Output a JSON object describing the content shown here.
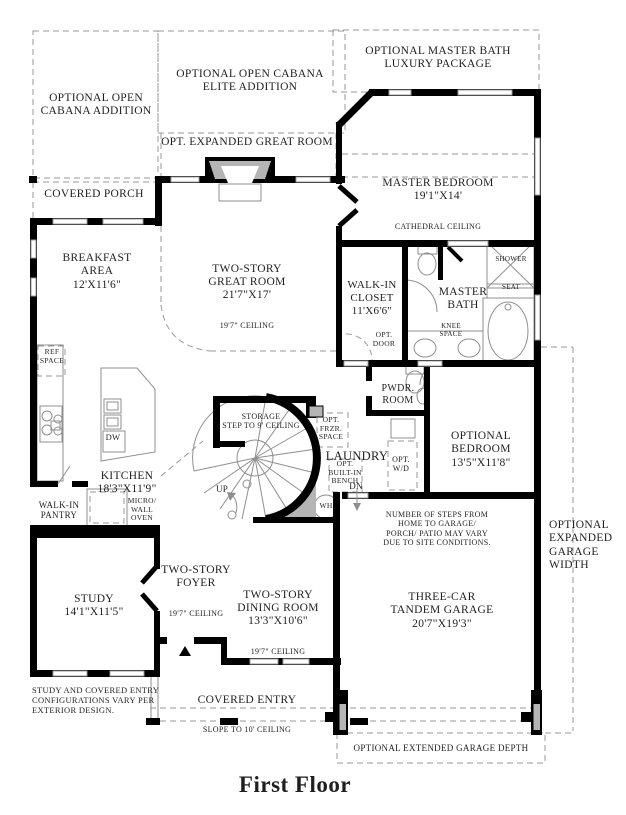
{
  "title": "First Floor",
  "palette": {
    "wall": "#000000",
    "dashed_line": "#9a9a9a",
    "fixture_line": "#8f8f8f",
    "poche_gray": "#b5b5b5",
    "text": "#1f1f1f"
  },
  "labels": {
    "cabana": {
      "text": "OPTIONAL OPEN\nCABANA ADDITION"
    },
    "cabanaElite": {
      "text": "OPTIONAL OPEN CABANA\nELITE ADDITION"
    },
    "masterBathLux": {
      "text": "OPTIONAL MASTER BATH\nLUXURY PACKAGE"
    },
    "optExpandedGreatRoom": {
      "text": "OPT. EXPANDED GREAT ROOM"
    },
    "coveredPorch": {
      "text": "COVERED PORCH"
    },
    "masterBedroom": {
      "text": "MASTER BEDROOM\n19'1\"X14'",
      "note": "CATHEDRAL CEILING"
    },
    "breakfast": {
      "text": "BREAKFAST\nAREA\n12'X11'6\""
    },
    "greatRoom": {
      "text": "TWO-STORY\nGREAT ROOM\n21'7\"X17'",
      "note": "19'7\" CEILING"
    },
    "walkInCloset": {
      "text": "WALK-IN\nCLOSET\n11'X6'6\""
    },
    "masterBath": {
      "text": "MASTER\nBATH"
    },
    "shower": {
      "text": "SHOWER"
    },
    "seat": {
      "text": "SEAT"
    },
    "kneeSpace": {
      "text": "KNEE\nSPACE"
    },
    "optDoor": {
      "text": "OPT.\nDOOR"
    },
    "refSpace": {
      "text": "REF\nSPACE"
    },
    "dw": {
      "text": "DW"
    },
    "kitchen": {
      "text": "KITCHEN\n18'3\"X11'9\""
    },
    "walkInPantry": {
      "text": "WALK-IN\nPANTRY"
    },
    "microWallOven": {
      "text": "MICRO/\nWALL\nOVEN"
    },
    "storage": {
      "text": "STORAGE\nSTEP TO 9' CEILING"
    },
    "optFrzr": {
      "text": "OPT.\nFRZR.\nSPACE"
    },
    "laundry": {
      "text": "LAUNDRY"
    },
    "optWd": {
      "text": "OPT.\nW/D"
    },
    "optBench": {
      "text": "OPT.\nBUILT-IN\nBENCH"
    },
    "up": {
      "text": "UP"
    },
    "dn": {
      "text": "DN"
    },
    "wh": {
      "text": "WH"
    },
    "pwdr": {
      "text": "PWDR.\nROOM"
    },
    "optBedroom": {
      "text": "OPTIONAL\nBEDROOM\n13'5\"X11'8\""
    },
    "study": {
      "text": "STUDY\n14'1\"X11'5\""
    },
    "foyer": {
      "text": "TWO-STORY\nFOYER",
      "note": "19'7\" CEILING"
    },
    "dining": {
      "text": "TWO-STORY\nDINING ROOM\n13'3\"X10'6\"",
      "note": "19'7\" CEILING"
    },
    "garage": {
      "text": "THREE-CAR\nTANDEM GARAGE\n20'7\"X19'3\""
    },
    "garageSteps": {
      "text": "NUMBER OF STEPS FROM\nHOME TO GARAGE/\nPORCH/ PATIO MAY VARY\nDUE TO SITE CONDITIONS."
    },
    "expGarageWidth": {
      "text": "OPTIONAL\nEXPANDED\nGARAGE\nWIDTH"
    },
    "coveredEntry": {
      "text": "COVERED ENTRY",
      "note": "SLOPE TO 10' CEILING"
    },
    "studyNote": {
      "text": "STUDY AND COVERED ENTRY\nCONFIGURATIONS VARY PER\nEXTERIOR DESIGN."
    },
    "extGarageDepth": {
      "text": "OPTIONAL EXTENDED GARAGE DEPTH"
    }
  }
}
